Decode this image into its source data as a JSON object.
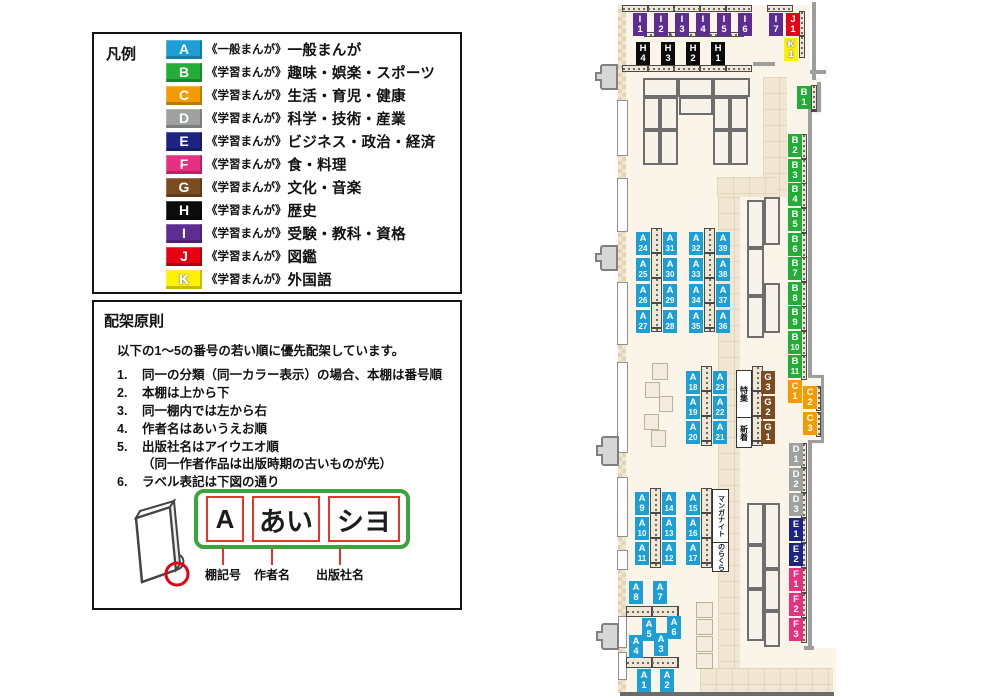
{
  "legend": {
    "title": "凡例",
    "items": [
      {
        "code": "A",
        "color": "#1D9FD6",
        "series": "《一般まんが》",
        "label": "一般まんが"
      },
      {
        "code": "B",
        "color": "#22AC38",
        "series": "《学習まんが》",
        "label": "趣味・娯楽・スポーツ"
      },
      {
        "code": "C",
        "color": "#F39C00",
        "series": "《学習まんが》",
        "label": "生活・育児・健康"
      },
      {
        "code": "D",
        "color": "#9FA0A0",
        "series": "《学習まんが》",
        "label": "科学・技術・産業"
      },
      {
        "code": "E",
        "color": "#1D2383",
        "series": "《学習まんが》",
        "label": "ビジネス・政治・経済"
      },
      {
        "code": "F",
        "color": "#E5317F",
        "series": "《学習まんが》",
        "label": "食・料理"
      },
      {
        "code": "G",
        "color": "#7B4B21",
        "series": "《学習まんが》",
        "label": "文化・音楽"
      },
      {
        "code": "H",
        "color": "#0B0B0B",
        "series": "《学習まんが》",
        "label": "歴史"
      },
      {
        "code": "I",
        "color": "#5E2D91",
        "series": "《学習まんが》",
        "label": "受験・教科・資格"
      },
      {
        "code": "J",
        "color": "#E60012",
        "series": "《学習まんが》",
        "label": "図鑑"
      },
      {
        "code": "K",
        "color": "#FFF103",
        "series": "《学習まんが》",
        "label": "外国語"
      }
    ]
  },
  "principles": {
    "title": "配架原則",
    "intro": "以下の1～5の番号の若い順に優先配架しています。",
    "items": [
      {
        "num": "1.",
        "text": "同一の分類（同一カラー表示）の場合、本棚は番号順"
      },
      {
        "num": "2.",
        "text": "本棚は上から下"
      },
      {
        "num": "3.",
        "text": "同一棚内では左から右"
      },
      {
        "num": "4.",
        "text": "作者名はあいうえお順"
      },
      {
        "num": "5.",
        "text": "出版社名はアイウエオ順",
        "note": "（同一作者作品は出版時期の古いものが先）"
      },
      {
        "num": "6.",
        "text": "ラベル表記は下図の通り"
      }
    ]
  },
  "diagram": {
    "segments": [
      {
        "text": "A",
        "caption": "棚記号"
      },
      {
        "text": "あい",
        "caption": "作者名"
      },
      {
        "text": "シヨ",
        "caption": "出版社名"
      }
    ]
  },
  "map": {
    "category_colors": {
      "A": "#1D9FD6",
      "B": "#22AC38",
      "C": "#F39C00",
      "D": "#9FA0A0",
      "E": "#1D2383",
      "F": "#E5317F",
      "G": "#7B4B21",
      "H": "#0B0B0B",
      "I": "#5E2D91",
      "J": "#E60012",
      "K": "#FFF103"
    },
    "labels": [
      {
        "c": "I",
        "n": "1",
        "x": 43,
        "y": 13
      },
      {
        "c": "I",
        "n": "2",
        "x": 64,
        "y": 13
      },
      {
        "c": "I",
        "n": "3",
        "x": 85,
        "y": 13
      },
      {
        "c": "I",
        "n": "4",
        "x": 106,
        "y": 13
      },
      {
        "c": "I",
        "n": "5",
        "x": 127,
        "y": 13
      },
      {
        "c": "I",
        "n": "6",
        "x": 148,
        "y": 13
      },
      {
        "c": "I",
        "n": "7",
        "x": 179,
        "y": 13
      },
      {
        "c": "J",
        "n": "1",
        "x": 196,
        "y": 13
      },
      {
        "c": "K",
        "n": "1",
        "x": 194,
        "y": 38
      },
      {
        "c": "H",
        "n": "4",
        "x": 46,
        "y": 42
      },
      {
        "c": "H",
        "n": "3",
        "x": 71,
        "y": 42
      },
      {
        "c": "H",
        "n": "2",
        "x": 96,
        "y": 42
      },
      {
        "c": "H",
        "n": "1",
        "x": 121,
        "y": 42
      },
      {
        "c": "B",
        "n": "1",
        "x": 207,
        "y": 86
      },
      {
        "c": "B",
        "n": "2",
        "x": 198,
        "y": 134
      },
      {
        "c": "B",
        "n": "3",
        "x": 198,
        "y": 159
      },
      {
        "c": "B",
        "n": "4",
        "x": 198,
        "y": 183
      },
      {
        "c": "B",
        "n": "5",
        "x": 198,
        "y": 208
      },
      {
        "c": "B",
        "n": "6",
        "x": 198,
        "y": 233
      },
      {
        "c": "B",
        "n": "7",
        "x": 198,
        "y": 257
      },
      {
        "c": "B",
        "n": "8",
        "x": 198,
        "y": 282
      },
      {
        "c": "B",
        "n": "9",
        "x": 198,
        "y": 306
      },
      {
        "c": "B",
        "n": "10",
        "x": 198,
        "y": 331
      },
      {
        "c": "B",
        "n": "11",
        "x": 198,
        "y": 355
      },
      {
        "c": "C",
        "n": "1",
        "x": 198,
        "y": 380
      },
      {
        "c": "C",
        "n": "2",
        "x": 213,
        "y": 386
      },
      {
        "c": "C",
        "n": "3",
        "x": 213,
        "y": 412
      },
      {
        "c": "D",
        "n": "1",
        "x": 199,
        "y": 443
      },
      {
        "c": "D",
        "n": "2",
        "x": 199,
        "y": 468
      },
      {
        "c": "D",
        "n": "3",
        "x": 199,
        "y": 493
      },
      {
        "c": "E",
        "n": "1",
        "x": 199,
        "y": 518
      },
      {
        "c": "E",
        "n": "2",
        "x": 199,
        "y": 543
      },
      {
        "c": "F",
        "n": "1",
        "x": 199,
        "y": 568
      },
      {
        "c": "F",
        "n": "2",
        "x": 199,
        "y": 593
      },
      {
        "c": "F",
        "n": "3",
        "x": 199,
        "y": 618
      },
      {
        "c": "G",
        "n": "3",
        "x": 171,
        "y": 371
      },
      {
        "c": "G",
        "n": "2",
        "x": 171,
        "y": 396
      },
      {
        "c": "G",
        "n": "1",
        "x": 171,
        "y": 421
      },
      {
        "c": "A",
        "n": "24",
        "x": 46,
        "y": 232
      },
      {
        "c": "A",
        "n": "25",
        "x": 46,
        "y": 258
      },
      {
        "c": "A",
        "n": "26",
        "x": 46,
        "y": 284
      },
      {
        "c": "A",
        "n": "27",
        "x": 46,
        "y": 310
      },
      {
        "c": "A",
        "n": "31",
        "x": 73,
        "y": 232
      },
      {
        "c": "A",
        "n": "30",
        "x": 73,
        "y": 258
      },
      {
        "c": "A",
        "n": "29",
        "x": 73,
        "y": 284
      },
      {
        "c": "A",
        "n": "28",
        "x": 73,
        "y": 310
      },
      {
        "c": "A",
        "n": "32",
        "x": 99,
        "y": 232
      },
      {
        "c": "A",
        "n": "33",
        "x": 99,
        "y": 258
      },
      {
        "c": "A",
        "n": "34",
        "x": 99,
        "y": 284
      },
      {
        "c": "A",
        "n": "35",
        "x": 99,
        "y": 310
      },
      {
        "c": "A",
        "n": "39",
        "x": 126,
        "y": 232
      },
      {
        "c": "A",
        "n": "38",
        "x": 126,
        "y": 258
      },
      {
        "c": "A",
        "n": "37",
        "x": 126,
        "y": 284
      },
      {
        "c": "A",
        "n": "36",
        "x": 126,
        "y": 310
      },
      {
        "c": "A",
        "n": "18",
        "x": 96,
        "y": 371
      },
      {
        "c": "A",
        "n": "19",
        "x": 96,
        "y": 396
      },
      {
        "c": "A",
        "n": "20",
        "x": 96,
        "y": 421
      },
      {
        "c": "A",
        "n": "23",
        "x": 123,
        "y": 371
      },
      {
        "c": "A",
        "n": "22",
        "x": 123,
        "y": 396
      },
      {
        "c": "A",
        "n": "21",
        "x": 123,
        "y": 421
      },
      {
        "c": "A",
        "n": "9",
        "x": 45,
        "y": 492
      },
      {
        "c": "A",
        "n": "10",
        "x": 45,
        "y": 517
      },
      {
        "c": "A",
        "n": "11",
        "x": 45,
        "y": 542
      },
      {
        "c": "A",
        "n": "14",
        "x": 72,
        "y": 492
      },
      {
        "c": "A",
        "n": "13",
        "x": 72,
        "y": 517
      },
      {
        "c": "A",
        "n": "12",
        "x": 72,
        "y": 542
      },
      {
        "c": "A",
        "n": "15",
        "x": 96,
        "y": 492
      },
      {
        "c": "A",
        "n": "16",
        "x": 96,
        "y": 517
      },
      {
        "c": "A",
        "n": "17",
        "x": 96,
        "y": 542
      },
      {
        "c": "A",
        "n": "8",
        "x": 39,
        "y": 581
      },
      {
        "c": "A",
        "n": "7",
        "x": 63,
        "y": 581
      },
      {
        "c": "A",
        "n": "5",
        "x": 52,
        "y": 618
      },
      {
        "c": "A",
        "n": "6",
        "x": 77,
        "y": 616
      },
      {
        "c": "A",
        "n": "4",
        "x": 39,
        "y": 635
      },
      {
        "c": "A",
        "n": "3",
        "x": 64,
        "y": 633
      },
      {
        "c": "A",
        "n": "1",
        "x": 47,
        "y": 669
      },
      {
        "c": "A",
        "n": "2",
        "x": 70,
        "y": 669
      }
    ],
    "signs": [
      {
        "id": "special-feature",
        "text": "特集",
        "x": 146,
        "y": 370,
        "w": 14,
        "h": 46,
        "fs": 8
      },
      {
        "id": "new-arrivals",
        "text": "新着",
        "x": 146,
        "y": 417,
        "w": 14,
        "h": 29,
        "fs": 8
      },
      {
        "id": "manga-night",
        "text": "マンガナイト",
        "x": 122,
        "y": 489,
        "w": 15,
        "h": 52,
        "fs": 7
      },
      {
        "id": "norakura",
        "text": "のらくら",
        "x": 122,
        "y": 542,
        "w": 15,
        "h": 28,
        "fs": 7
      }
    ]
  }
}
